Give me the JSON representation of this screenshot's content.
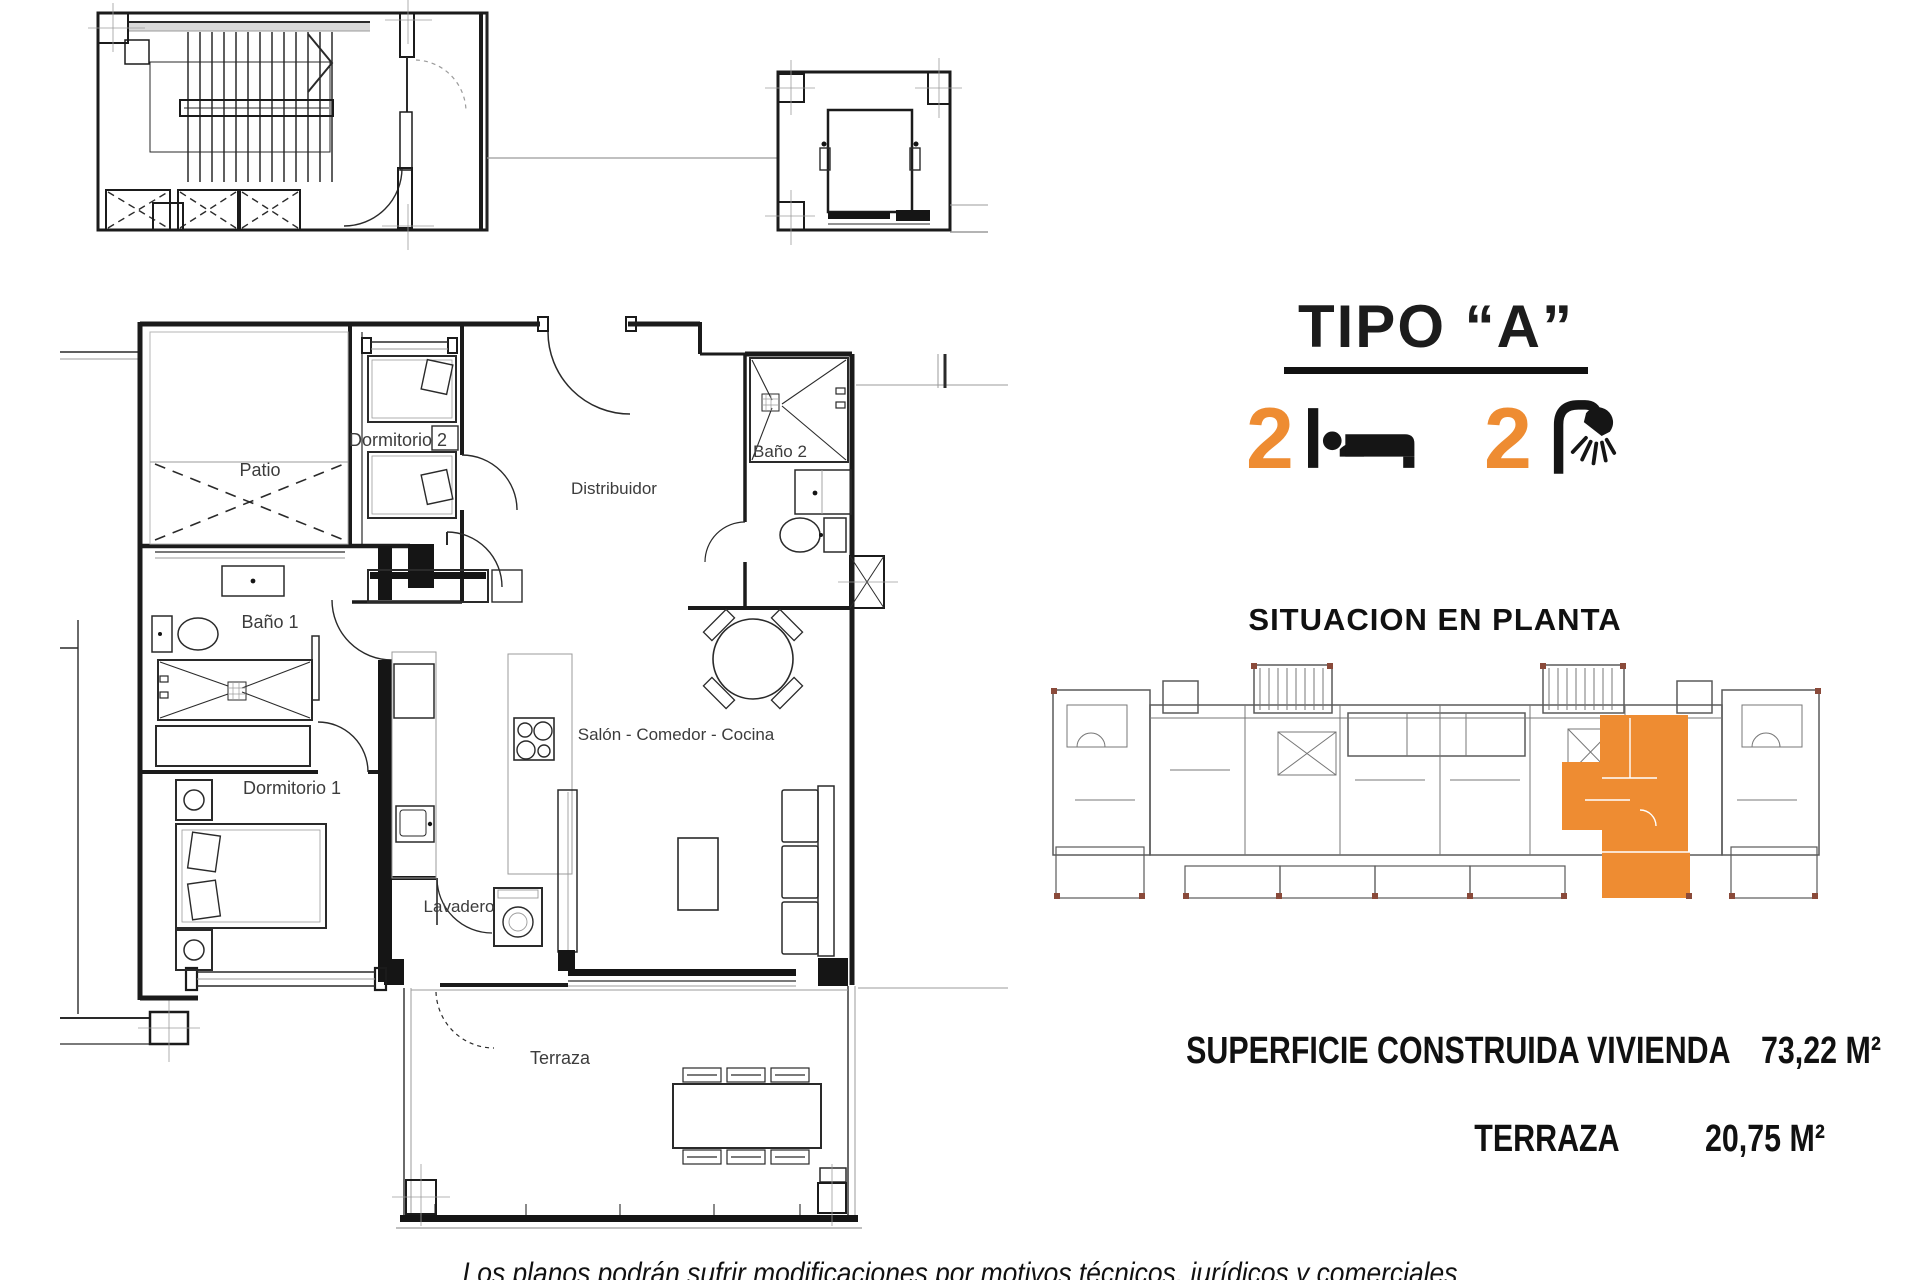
{
  "title": "TIPO “A”",
  "features": {
    "bedrooms": "2",
    "bathrooms": "2"
  },
  "situacion_heading": "SITUACION EN PLANTA",
  "areas": {
    "construida_label": "SUPERFICIE CONSTRUIDA VIVIENDA",
    "construida_value": "73,22 M²",
    "terraza_label": "TERRAZA",
    "terraza_value": "20,75 M²"
  },
  "disclaimer": "Los planos podrán sufrir modificaciones por motivos técnicos, jurídicos y comerciales",
  "rooms": {
    "patio": "Patio",
    "dormitorio2": "Dormitorio 2",
    "bano2": "Baño 2",
    "distribuidor": "Distribuidor",
    "bano1": "Baño 1",
    "dormitorio1": "Dormitorio 1",
    "salon": "Salón - Comedor - Cocina",
    "lavadero": "Lavadero",
    "terraza": "Terraza"
  },
  "colors": {
    "accent": "#EE8C32",
    "line": "#1B1B1B",
    "gray": "#9B9B9B"
  }
}
